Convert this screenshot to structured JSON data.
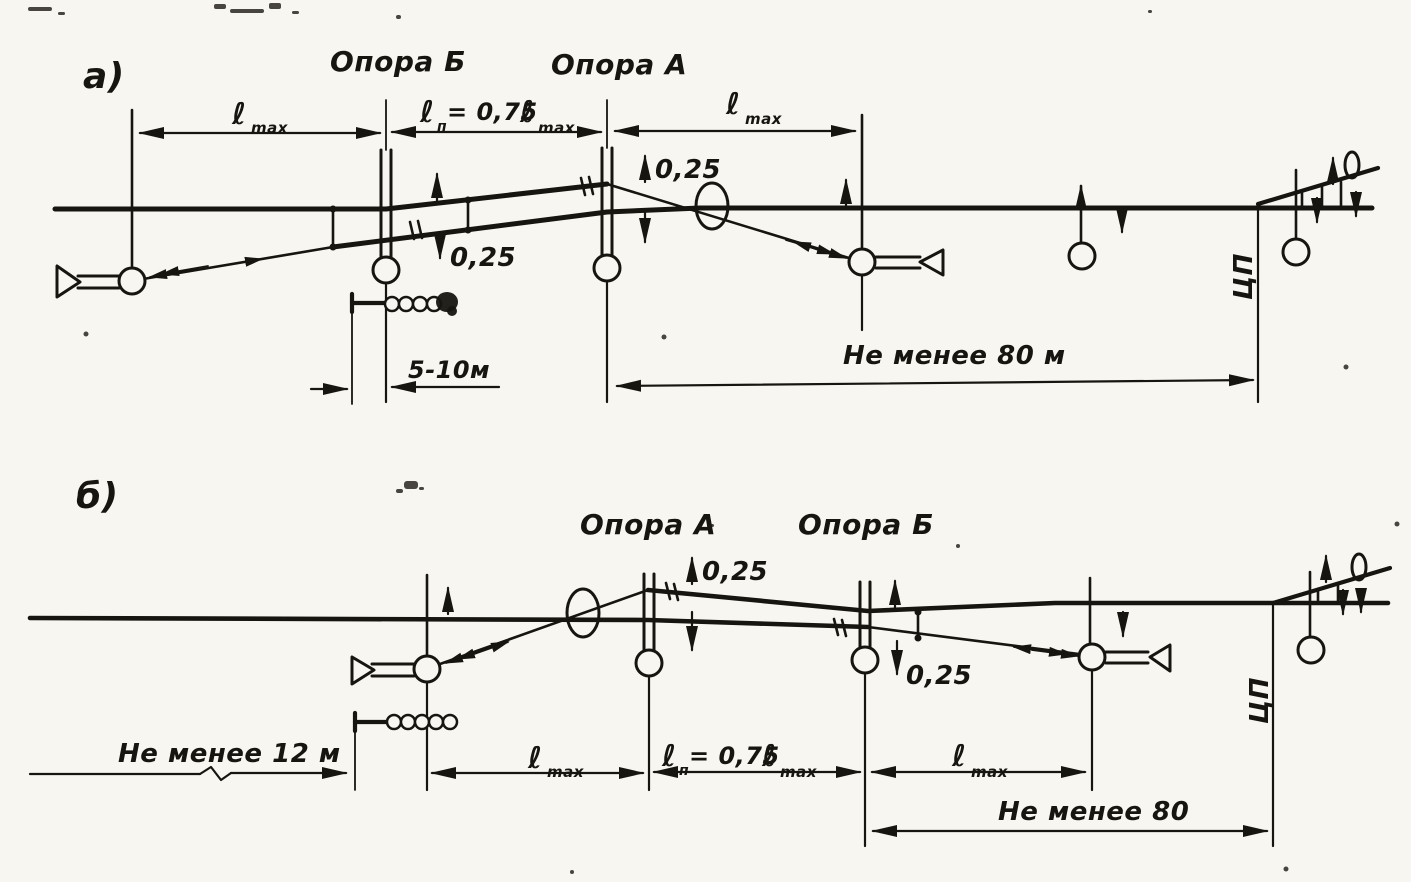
{
  "colors": {
    "paper": "#f7f6f1",
    "ink": "#17150f"
  },
  "panel_a": {
    "tag": "а)",
    "support_b_label": "Опора Б",
    "support_a_label": "Опора А",
    "span_left": {
      "ell": "ℓ",
      "sub": "max"
    },
    "span_mid": {
      "ell": "ℓ",
      "sub": "п",
      "rest": "= 0,75",
      "ell2": "ℓ",
      "sub2": "max"
    },
    "span_right": {
      "ell": "ℓ",
      "sub": "max"
    },
    "offset_at_b": "0,25",
    "offset_at_a": "0,25",
    "weights_offset": "5-10м",
    "min_distance": "Не менее 80 м",
    "cp": "ЦП"
  },
  "panel_b": {
    "tag": "б)",
    "support_a_label": "Опора А",
    "support_b_label": "Опора Б",
    "offset_at_a": "0,25",
    "offset_at_b": "0,25",
    "min_left": "Не менее 12 м",
    "span_left": {
      "ell": "ℓ",
      "sub": "max"
    },
    "span_mid": {
      "ell": "ℓ",
      "sub": "п",
      "rest": "= 0,75",
      "ell2": "ℓ",
      "sub2": "max"
    },
    "span_right": {
      "ell": "ℓ",
      "sub": "max"
    },
    "min_distance": "Не менее 80",
    "cp": "ЦП"
  }
}
